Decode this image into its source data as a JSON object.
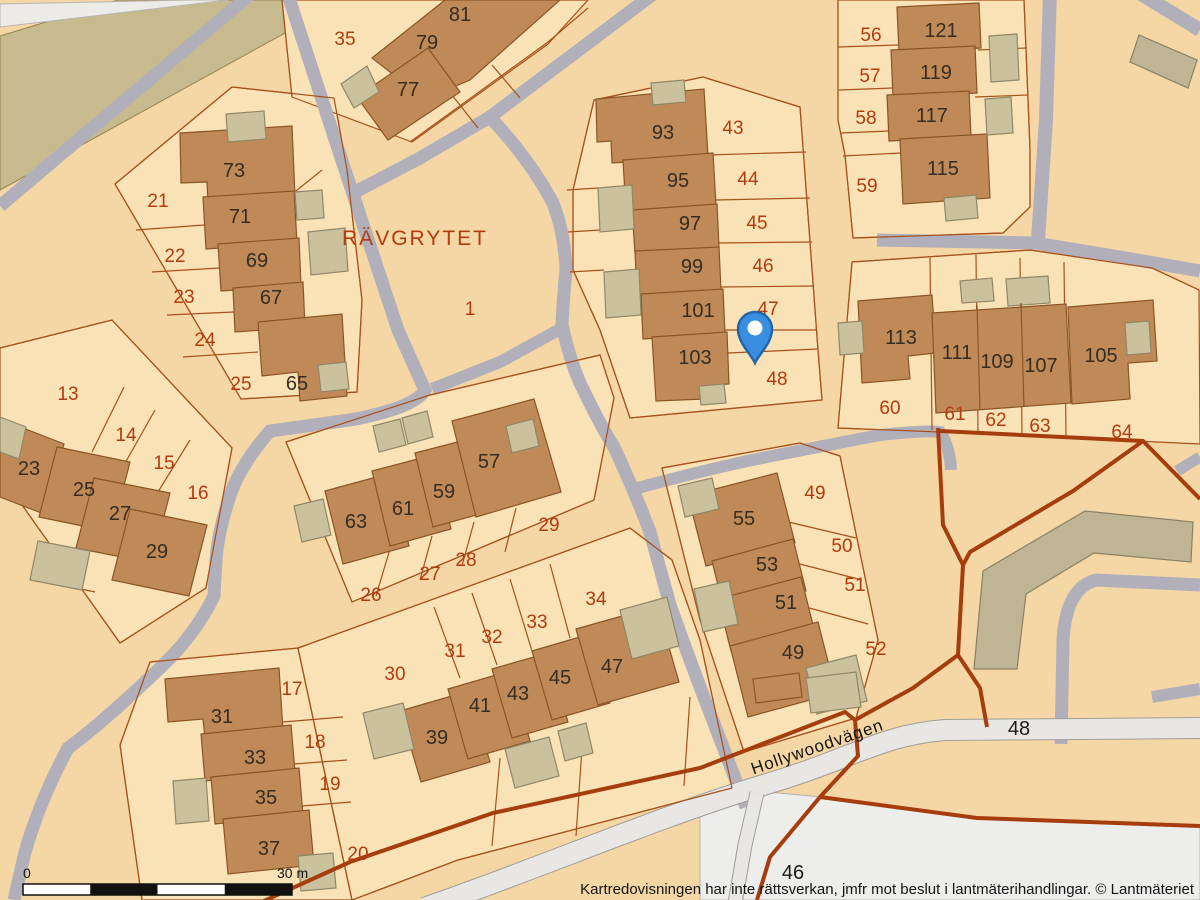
{
  "footer": {
    "disclaimer": "Kartredovisningen har inte rättsverkan, jmfr mot beslut i lantmäterihandlingar. © Lantmäteriet"
  },
  "scale_bar": {
    "start_label": "0",
    "end_label": "30 m",
    "x": 23,
    "y": 884,
    "width": 269,
    "height": 11,
    "segments": 4,
    "colors": [
      "#ffffff",
      "#111111"
    ]
  },
  "map": {
    "colors": {
      "background": "#f4d7a4",
      "lot_fill": "#f9e2b5",
      "parcel_line": "#a8511d",
      "road_gray": "#b1afba",
      "road_light_fill": "#e9e7e4",
      "road_light_casing": "#a09d99",
      "white_strip": "#edebe8",
      "white_area": "#ededec",
      "khaki_band_fill": "#c6ba8e",
      "khaki_band_stroke": "#97824e",
      "building_brown": "#c08a58",
      "building_brown_stroke": "#8a5425",
      "building_khaki": "#cbc29d",
      "building_khaki_stroke": "#8f8768",
      "big_khaki_fill": "#bfb594",
      "big_khaki_stroke": "#8a8164",
      "boundary_red": "#a63d0e",
      "label_building": "#362c20",
      "label_parcel": "#b23c10",
      "pin_fill": "#3a8ee0",
      "pin_stroke": "#2266aa"
    },
    "khaki_band": "0,36 118,0 345,0 0,190",
    "white_strip": "0,27 228,0 192,0 0,4",
    "white_area": "700,812 757,791 822,797 978,818 1200,827 1200,900 700,900",
    "lots": [
      "115,184 232,87 334,98 347,170 362,300 357,392 241,399",
      "292,97 282,0 588,0 548,44 412,142",
      "594,100 703,77 800,107 818,350 822,400 630,418 600,330 573,270 573,190",
      "838,0 1024,0 1030,150 1030,207 1003,233 853,238 845,155 838,120",
      "852,262 1030,250 1152,268 1199,290 1200,444 940,432 838,428",
      "0,348 112,320 232,448 206,588 120,643 0,474",
      "286,442 430,395 600,355 614,398 594,500 352,602",
      "150,662 298,648 352,900 142,900 120,745",
      "298,648 630,528 672,560 700,640 732,788 458,860 352,900",
      "662,468 800,443 840,456 878,640 856,718 744,752 700,620"
    ],
    "roads_gray": [
      {
        "d": "M253,-8 L0,206",
        "w": 13
      },
      {
        "d": "M287,-8 L345,170 Q375,260 398,330 Q418,375 425,390 Q415,408 350,420 Q300,427 270,431 Q243,462 232,490 Q218,530 216,560 L214,596 Q195,635 160,668 Q100,725 68,748 Q40,800 25,852 L14,900",
        "w": 13
      },
      {
        "d": "M656,-8 L490,117 Q530,160 553,203 Q565,235 566,270 Q563,300 562,325 Q570,360 580,383 Q600,425 614,447 Q634,490 650,532 L670,605 Q688,655 702,692 L746,807",
        "w": 13
      },
      {
        "d": "M490,117 L420,158 L357,191",
        "w": 13
      },
      {
        "d": "M562,328 L500,362 L432,389",
        "w": 12
      },
      {
        "d": "M634,489 Q720,466 772,456 L880,435 Q928,430 940,432 Q950,447 951,470",
        "w": 12
      },
      {
        "d": "M877,240 L1035,243 L1120,257 L1200,271",
        "w": 13
      },
      {
        "d": "M1050,-8 L1046,120 L1038,240",
        "w": 14
      },
      {
        "d": "M1141,-6 L1200,30",
        "w": 14
      },
      {
        "d": "M1061,744 L1063,640 Q1066,588 1096,580 L1200,585",
        "w": 13
      },
      {
        "d": "M1152,697 L1200,689",
        "w": 12
      },
      {
        "d": "M1177,471 L1200,457",
        "w": 11
      }
    ],
    "roads_light": [
      {
        "d": "M424,908 C540,868 650,820 760,786 C850,760 880,735 945,730 L1200,728",
        "w": 20
      },
      {
        "d": "M757,793 L745,845 L735,903",
        "w": 13
      }
    ],
    "parcel_lines": [
      "M115,184 L232,87 L334,98 L347,170 L362,300 L357,392 L241,399 Z",
      "M136,230 L204,225",
      "M152,272 L220,268",
      "M167,315 L234,312",
      "M183,357 L258,352",
      "M322,170 L281,203",
      "M292,97 L282,0",
      "M410,142 L548,42 L588,8",
      "M452,95 L478,128",
      "M492,65 L520,98",
      "M594,100 L703,77 L800,107 L818,350 L822,400 L630,418 L600,330 L573,270 L573,190 Z",
      "M708,155 L806,152",
      "M716,200 L810,198",
      "M718,243 L812,242",
      "M720,287 L814,286",
      "M724,330 L816,330",
      "M728,353 L818,349",
      "M567,190 L598,188",
      "M568,232 L600,230",
      "M570,272 L604,270",
      "M838,0 L838,120 L845,155 L853,238 L1003,233 L1030,207 L1030,150 L1024,0",
      "M838,47 L898,45",
      "M839,90 L893,88",
      "M841,133 L889,131",
      "M843,156 L901,153",
      "M978,50 L1027,48",
      "M975,97 L1028,95",
      "M852,262 L1030,250 L1152,268 L1199,290",
      "M852,262 L838,428 L940,432",
      "M930,258 L932,430",
      "M976,255 L978,432",
      "M1020,258 L1022,434",
      "M1064,262 L1066,436",
      "M0,348 L112,320 L232,448 L206,588 L120,643 L0,474",
      "M124,387 L92,452",
      "M155,410 L120,472",
      "M190,440 L153,500",
      "M30,578 L95,592",
      "M286,442 L430,395 L600,355 L614,398 L594,500 L352,602 Z",
      "M390,549 L376,596",
      "M432,536 L420,580",
      "M474,522 L462,566",
      "M516,508 L505,552",
      "M150,662 L298,648 L352,900",
      "M150,662 L120,745 L142,900",
      "M283,722 L343,717",
      "M294,764 L347,760",
      "M302,806 L351,802",
      "M298,648 L630,528 L672,560 L700,640 L732,788",
      "M732,788 L458,860 L352,900",
      "M434,607 L460,678",
      "M472,593 L497,665",
      "M510,579 L532,651",
      "M550,564 L570,638",
      "M500,758 L492,846",
      "M582,748 L576,836",
      "M690,697 L684,786",
      "M662,468 L800,443 L840,456 L878,640 L856,718 L744,752 L700,620 L662,468",
      "M780,520 L856,538",
      "M792,562 L862,580",
      "M802,606 L868,624"
    ],
    "buildings": [
      {
        "t": "b",
        "p": "180,133 292,126 295,197 208,203 207,182 181,183"
      },
      {
        "t": "b",
        "p": "203,197 294,191 297,243 206,249"
      },
      {
        "t": "b",
        "p": "218,244 299,238 301,286 221,291"
      },
      {
        "t": "b",
        "p": "233,288 303,282 305,327 235,332"
      },
      {
        "t": "b",
        "p": "258,322 342,314 347,396 300,401 298,372 262,376"
      },
      {
        "t": "k",
        "p": "226,114 264,111 266,139 228,142"
      },
      {
        "t": "k",
        "p": "295,192 322,190 324,218 297,220"
      },
      {
        "t": "k",
        "p": "308,232 345,228 348,271 311,275"
      },
      {
        "t": "k",
        "p": "318,365 346,362 349,389 321,392"
      },
      {
        "t": "b",
        "p": "372,58 445,0 560,0 470,80 425,99"
      },
      {
        "t": "b",
        "p": "357,97 428,48 460,92 388,140"
      },
      {
        "t": "k",
        "p": "341,84 367,66 379,92 354,108"
      },
      {
        "t": "b",
        "p": "596,99 704,89 708,157 612,163 611,141 597,142"
      },
      {
        "t": "b",
        "p": "623,160 713,153 716,206 626,212"
      },
      {
        "t": "b",
        "p": "632,210 717,204 719,248 635,253"
      },
      {
        "t": "b",
        "p": "635,251 719,247 721,291 637,296"
      },
      {
        "t": "b",
        "p": "641,294 723,289 725,334 643,339"
      },
      {
        "t": "b",
        "p": "652,337 727,332 729,384 703,386 704,399 656,401"
      },
      {
        "t": "k",
        "p": "651,83 684,80 686,102 653,105"
      },
      {
        "t": "k",
        "p": "598,188 632,185 634,229 600,232"
      },
      {
        "t": "k",
        "p": "604,272 639,269 641,315 606,318"
      },
      {
        "t": "k",
        "p": "699,386 724,384 726,403 701,405"
      },
      {
        "t": "b",
        "p": "897,7 979,3 981,48 899,52"
      },
      {
        "t": "b",
        "p": "891,50 975,46 977,93 893,97"
      },
      {
        "t": "b",
        "p": "887,95 969,91 971,137 889,141"
      },
      {
        "t": "b",
        "p": "900,139 987,134 990,198 903,204"
      },
      {
        "t": "k",
        "p": "989,36 1017,34 1019,80 991,82"
      },
      {
        "t": "k",
        "p": "985,99 1011,97 1013,133 987,135"
      },
      {
        "t": "k",
        "p": "944,198 976,195 978,218 946,221"
      },
      {
        "t": "b",
        "p": "858,301 932,295 936,353 908,356 910,379 862,383"
      },
      {
        "t": "b",
        "p": "932,313 1066,304 1071,403 936,413"
      },
      {
        "t": "b",
        "p": "1068,307 1153,300 1157,361 1128,363 1130,399 1072,404"
      },
      {
        "t": "k",
        "p": "1125,323 1149,321 1151,353 1127,355"
      },
      {
        "t": "k",
        "p": "838,323 862,321 864,353 840,355"
      },
      {
        "t": "k",
        "p": "960,281 992,278 994,301 962,303"
      },
      {
        "t": "k",
        "p": "1006,279 1048,276 1050,303 1008,306"
      },
      {
        "t": "b",
        "p": "0,419 64,444 44,514 0,497"
      },
      {
        "t": "b",
        "p": "57,447 130,462 112,532 39,517"
      },
      {
        "t": "b",
        "p": "94,478 170,493 152,563 76,548"
      },
      {
        "t": "b",
        "p": "130,509 207,525 189,596 112,580"
      },
      {
        "t": "k",
        "p": "0,417 26,427 19,459 0,452"
      },
      {
        "t": "k",
        "p": "38,541 90,551 82,590 30,580"
      },
      {
        "t": "b",
        "p": "325,491 391,473 409,546 343,564"
      },
      {
        "t": "b",
        "p": "372,471 433,455 451,529 390,546"
      },
      {
        "t": "b",
        "p": "415,453 473,438 491,511 433,527"
      },
      {
        "t": "b",
        "p": "452,421 534,399 561,492 476,517"
      },
      {
        "t": "k",
        "p": "373,426 400,419 406,445 379,452"
      },
      {
        "t": "k",
        "p": "402,418 427,411 433,437 408,444"
      },
      {
        "t": "k",
        "p": "506,426 533,419 539,446 512,453"
      },
      {
        "t": "k",
        "p": "294,506 323,499 331,535 302,542"
      },
      {
        "t": "b",
        "p": "165,679 279,668 283,731 205,738 203,719 168,722"
      },
      {
        "t": "b",
        "p": "201,734 291,725 295,772 205,781"
      },
      {
        "t": "b",
        "p": "211,777 299,768 303,815 215,824"
      },
      {
        "t": "b",
        "p": "223,819 309,810 314,865 228,874"
      },
      {
        "t": "k",
        "p": "173,781 206,778 209,821 176,824"
      },
      {
        "t": "k",
        "p": "298,856 333,853 336,888 301,891"
      },
      {
        "t": "b",
        "p": "400,711 469,691 490,762 421,782"
      },
      {
        "t": "b",
        "p": "448,689 510,671 530,741 468,759"
      },
      {
        "t": "b",
        "p": "492,669 548,653 568,722 512,738"
      },
      {
        "t": "b",
        "p": "532,651 590,634 610,703 552,720"
      },
      {
        "t": "b",
        "p": "576,629 657,606 679,682 598,705"
      },
      {
        "t": "k",
        "p": "363,713 403,703 414,749 374,759"
      },
      {
        "t": "k",
        "p": "505,749 549,737 559,776 515,788"
      },
      {
        "t": "k",
        "p": "558,731 586,723 593,753 565,761"
      },
      {
        "t": "k",
        "p": "620,610 667,597 679,646 632,659"
      },
      {
        "t": "b",
        "p": "688,496 777,473 795,543 706,566"
      },
      {
        "t": "b",
        "p": "712,561 793,539 806,591 725,613"
      },
      {
        "t": "b",
        "p": "718,599 801,577 814,629 731,651"
      },
      {
        "t": "b",
        "p": "730,646 818,622 836,693 748,717"
      },
      {
        "t": "k",
        "p": "806,668 856,655 867,701 817,714"
      },
      {
        "t": "k",
        "p": "678,486 712,478 719,509 685,517"
      },
      {
        "t": "k",
        "p": "694,589 729,581 738,624 703,632"
      },
      {
        "t": "b",
        "p": "753,679 799,673 802,697 756,703"
      },
      {
        "t": "k",
        "p": "806,678 856,672 861,707 811,713"
      },
      {
        "t": "K",
        "p": "983,571 1085,511 1193,522 1191,562 1094,553 1026,594 1017,669 974,669"
      },
      {
        "t": "K",
        "p": "1139,35 1197,60 1188,88 1130,62"
      }
    ],
    "unit_lines": [
      "M977,305 L980,410",
      "M1021,303 L1024,407"
    ],
    "boundaries": [
      "M255,905 L350,862 L493,813 L700,768 L845,712 L855,720",
      "M938,428 L943,525 L963,565 L958,655 L980,688 L987,727",
      "M958,655 L913,688 L855,720 L858,756 L820,797 L770,857 L757,900",
      "M820,797 L977,818 L1200,826",
      "M940,431 L1143,441 L1200,499",
      "M1143,441 L1073,491 L970,552 L963,565"
    ],
    "labels_parcel": [
      {
        "t": "35",
        "x": 345,
        "y": 45
      },
      {
        "t": "21",
        "x": 158,
        "y": 207
      },
      {
        "t": "22",
        "x": 175,
        "y": 262
      },
      {
        "t": "23",
        "x": 184,
        "y": 303
      },
      {
        "t": "24",
        "x": 205,
        "y": 346
      },
      {
        "t": "25",
        "x": 241,
        "y": 390
      },
      {
        "t": "13",
        "x": 68,
        "y": 400
      },
      {
        "t": "14",
        "x": 126,
        "y": 441
      },
      {
        "t": "15",
        "x": 164,
        "y": 469
      },
      {
        "t": "16",
        "x": 198,
        "y": 499
      },
      {
        "t": "1",
        "x": 470,
        "y": 315
      },
      {
        "t": "43",
        "x": 733,
        "y": 134
      },
      {
        "t": "44",
        "x": 748,
        "y": 185
      },
      {
        "t": "45",
        "x": 757,
        "y": 229
      },
      {
        "t": "46",
        "x": 763,
        "y": 272
      },
      {
        "t": "47",
        "x": 768,
        "y": 315
      },
      {
        "t": "48",
        "x": 777,
        "y": 385
      },
      {
        "t": "56",
        "x": 871,
        "y": 41
      },
      {
        "t": "57",
        "x": 870,
        "y": 82
      },
      {
        "t": "58",
        "x": 866,
        "y": 124
      },
      {
        "t": "59",
        "x": 867,
        "y": 192
      },
      {
        "t": "60",
        "x": 890,
        "y": 414
      },
      {
        "t": "61",
        "x": 955,
        "y": 420
      },
      {
        "t": "62",
        "x": 996,
        "y": 426
      },
      {
        "t": "63",
        "x": 1040,
        "y": 432
      },
      {
        "t": "64",
        "x": 1122,
        "y": 438
      },
      {
        "t": "26",
        "x": 371,
        "y": 601
      },
      {
        "t": "27",
        "x": 430,
        "y": 580
      },
      {
        "t": "28",
        "x": 466,
        "y": 566
      },
      {
        "t": "29",
        "x": 549,
        "y": 531
      },
      {
        "t": "30",
        "x": 395,
        "y": 680
      },
      {
        "t": "31",
        "x": 455,
        "y": 657
      },
      {
        "t": "32",
        "x": 492,
        "y": 643
      },
      {
        "t": "33",
        "x": 537,
        "y": 628
      },
      {
        "t": "34",
        "x": 596,
        "y": 605
      },
      {
        "t": "17",
        "x": 292,
        "y": 695
      },
      {
        "t": "18",
        "x": 315,
        "y": 748
      },
      {
        "t": "19",
        "x": 330,
        "y": 790
      },
      {
        "t": "20",
        "x": 358,
        "y": 860
      },
      {
        "t": "49",
        "x": 815,
        "y": 499
      },
      {
        "t": "50",
        "x": 842,
        "y": 552
      },
      {
        "t": "51",
        "x": 855,
        "y": 591
      },
      {
        "t": "52",
        "x": 876,
        "y": 655
      }
    ],
    "labels_building": [
      {
        "t": "81",
        "x": 460,
        "y": 21
      },
      {
        "t": "79",
        "x": 427,
        "y": 49
      },
      {
        "t": "77",
        "x": 408,
        "y": 96
      },
      {
        "t": "73",
        "x": 234,
        "y": 177
      },
      {
        "t": "71",
        "x": 240,
        "y": 223
      },
      {
        "t": "69",
        "x": 257,
        "y": 267
      },
      {
        "t": "67",
        "x": 271,
        "y": 304
      },
      {
        "t": "65",
        "x": 297,
        "y": 390
      },
      {
        "t": "93",
        "x": 663,
        "y": 139
      },
      {
        "t": "95",
        "x": 678,
        "y": 187
      },
      {
        "t": "97",
        "x": 690,
        "y": 230
      },
      {
        "t": "99",
        "x": 692,
        "y": 273
      },
      {
        "t": "101",
        "x": 698,
        "y": 317
      },
      {
        "t": "103",
        "x": 695,
        "y": 364
      },
      {
        "t": "121",
        "x": 941,
        "y": 37
      },
      {
        "t": "119",
        "x": 936,
        "y": 79
      },
      {
        "t": "117",
        "x": 932,
        "y": 122
      },
      {
        "t": "115",
        "x": 943,
        "y": 175
      },
      {
        "t": "23",
        "x": 29,
        "y": 475
      },
      {
        "t": "25",
        "x": 84,
        "y": 496
      },
      {
        "t": "27",
        "x": 120,
        "y": 520
      },
      {
        "t": "29",
        "x": 157,
        "y": 558
      },
      {
        "t": "113",
        "x": 901,
        "y": 344
      },
      {
        "t": "111",
        "x": 957,
        "y": 359
      },
      {
        "t": "109",
        "x": 997,
        "y": 368
      },
      {
        "t": "107",
        "x": 1041,
        "y": 372
      },
      {
        "t": "105",
        "x": 1101,
        "y": 362
      },
      {
        "t": "57",
        "x": 489,
        "y": 468
      },
      {
        "t": "59",
        "x": 444,
        "y": 498
      },
      {
        "t": "61",
        "x": 403,
        "y": 515
      },
      {
        "t": "63",
        "x": 356,
        "y": 528
      },
      {
        "t": "55",
        "x": 744,
        "y": 525
      },
      {
        "t": "53",
        "x": 767,
        "y": 571
      },
      {
        "t": "51",
        "x": 786,
        "y": 609
      },
      {
        "t": "49",
        "x": 793,
        "y": 659
      },
      {
        "t": "31",
        "x": 222,
        "y": 723
      },
      {
        "t": "33",
        "x": 255,
        "y": 764
      },
      {
        "t": "35",
        "x": 266,
        "y": 804
      },
      {
        "t": "37",
        "x": 269,
        "y": 855
      },
      {
        "t": "39",
        "x": 437,
        "y": 744
      },
      {
        "t": "41",
        "x": 480,
        "y": 712
      },
      {
        "t": "43",
        "x": 518,
        "y": 700
      },
      {
        "t": "45",
        "x": 560,
        "y": 684
      },
      {
        "t": "47",
        "x": 612,
        "y": 673
      }
    ],
    "labels_road": [
      {
        "t": "48",
        "x": 1019,
        "y": 735
      },
      {
        "t": "46",
        "x": 793,
        "y": 879
      }
    ],
    "place_label": {
      "t": "RÄVGRYTET",
      "x": 415,
      "y": 245
    },
    "street_label": {
      "t": "Hollywoodvägen",
      "x": 819,
      "y": 752,
      "rot": -19
    },
    "pin": {
      "x": 755,
      "y": 330
    }
  }
}
